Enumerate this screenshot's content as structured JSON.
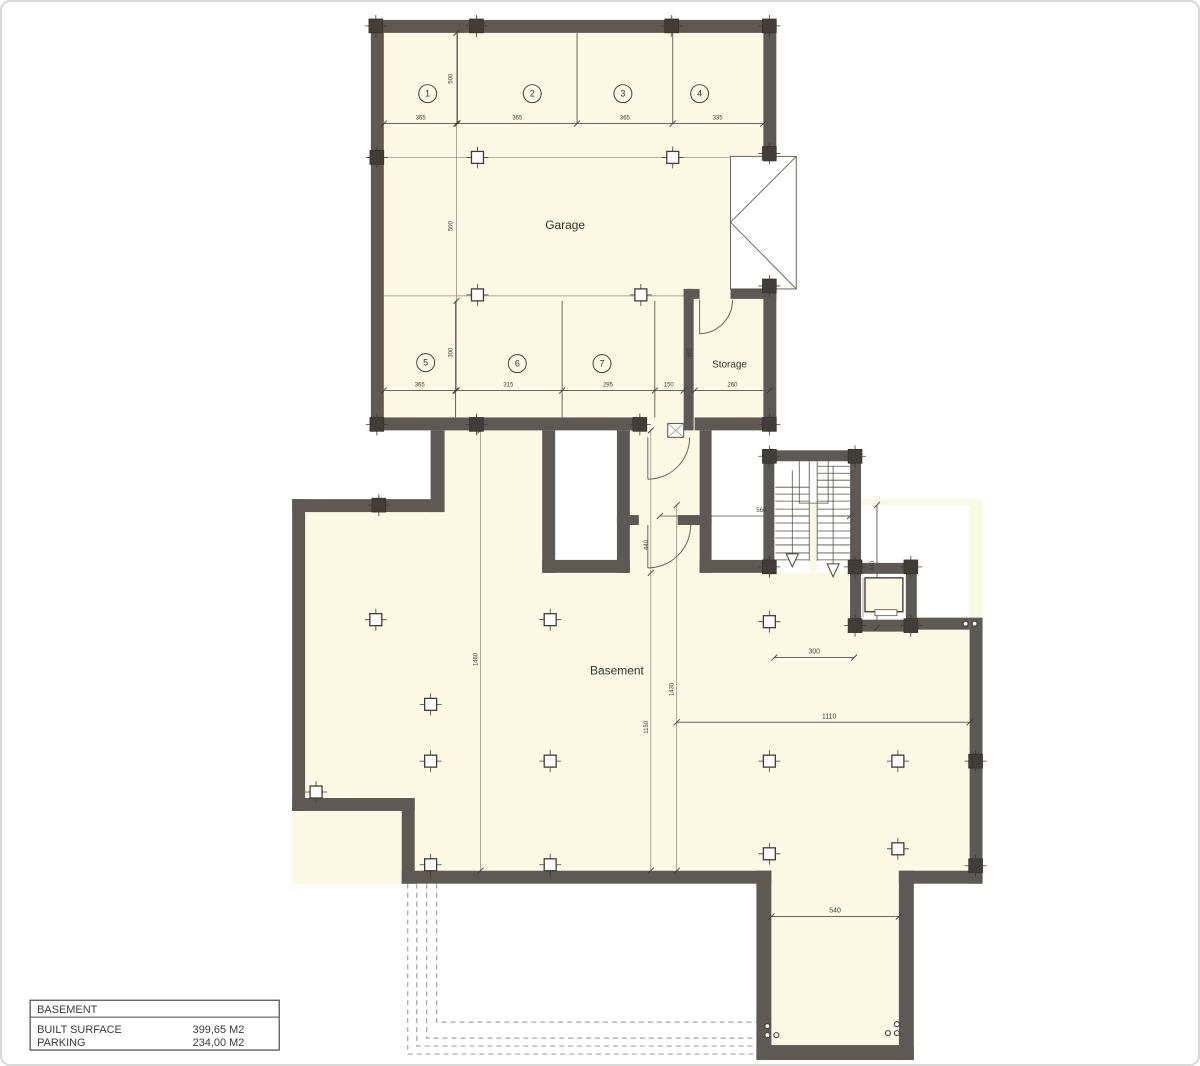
{
  "plan": {
    "rooms": {
      "garage": "Garage",
      "storage": "Storage",
      "basement": "Basement"
    },
    "parking_spaces": [
      "1",
      "2",
      "3",
      "4",
      "5",
      "6",
      "7"
    ],
    "dimensions": {
      "garage_top_row": [
        "365",
        "365",
        "365",
        "335"
      ],
      "garage_bottom_row": [
        "365",
        "315",
        "295",
        "150"
      ],
      "storage_width": "260",
      "storage_depth": "460",
      "garage_depths": [
        "500",
        "500",
        "300"
      ],
      "vestibule_depth": "440",
      "stair_width": "560",
      "stair_side": "440",
      "pillar_spacing": "300",
      "basement_right_width": "1110",
      "basement_left_depth": "1460",
      "basement_mid_depth": "1430",
      "basement_center_depth": "1150",
      "extension_width": "540"
    },
    "legend": {
      "title": "BASEMENT",
      "rows": [
        {
          "label": "BUILT SURFACE",
          "value": "399,65 M2"
        },
        {
          "label": "PARKING",
          "value": "234,00 M2"
        }
      ]
    },
    "colors": {
      "wall": "#5e5954",
      "floor": "#fbf8e3",
      "line": "#6a655f",
      "text": "#3f3b38"
    }
  }
}
